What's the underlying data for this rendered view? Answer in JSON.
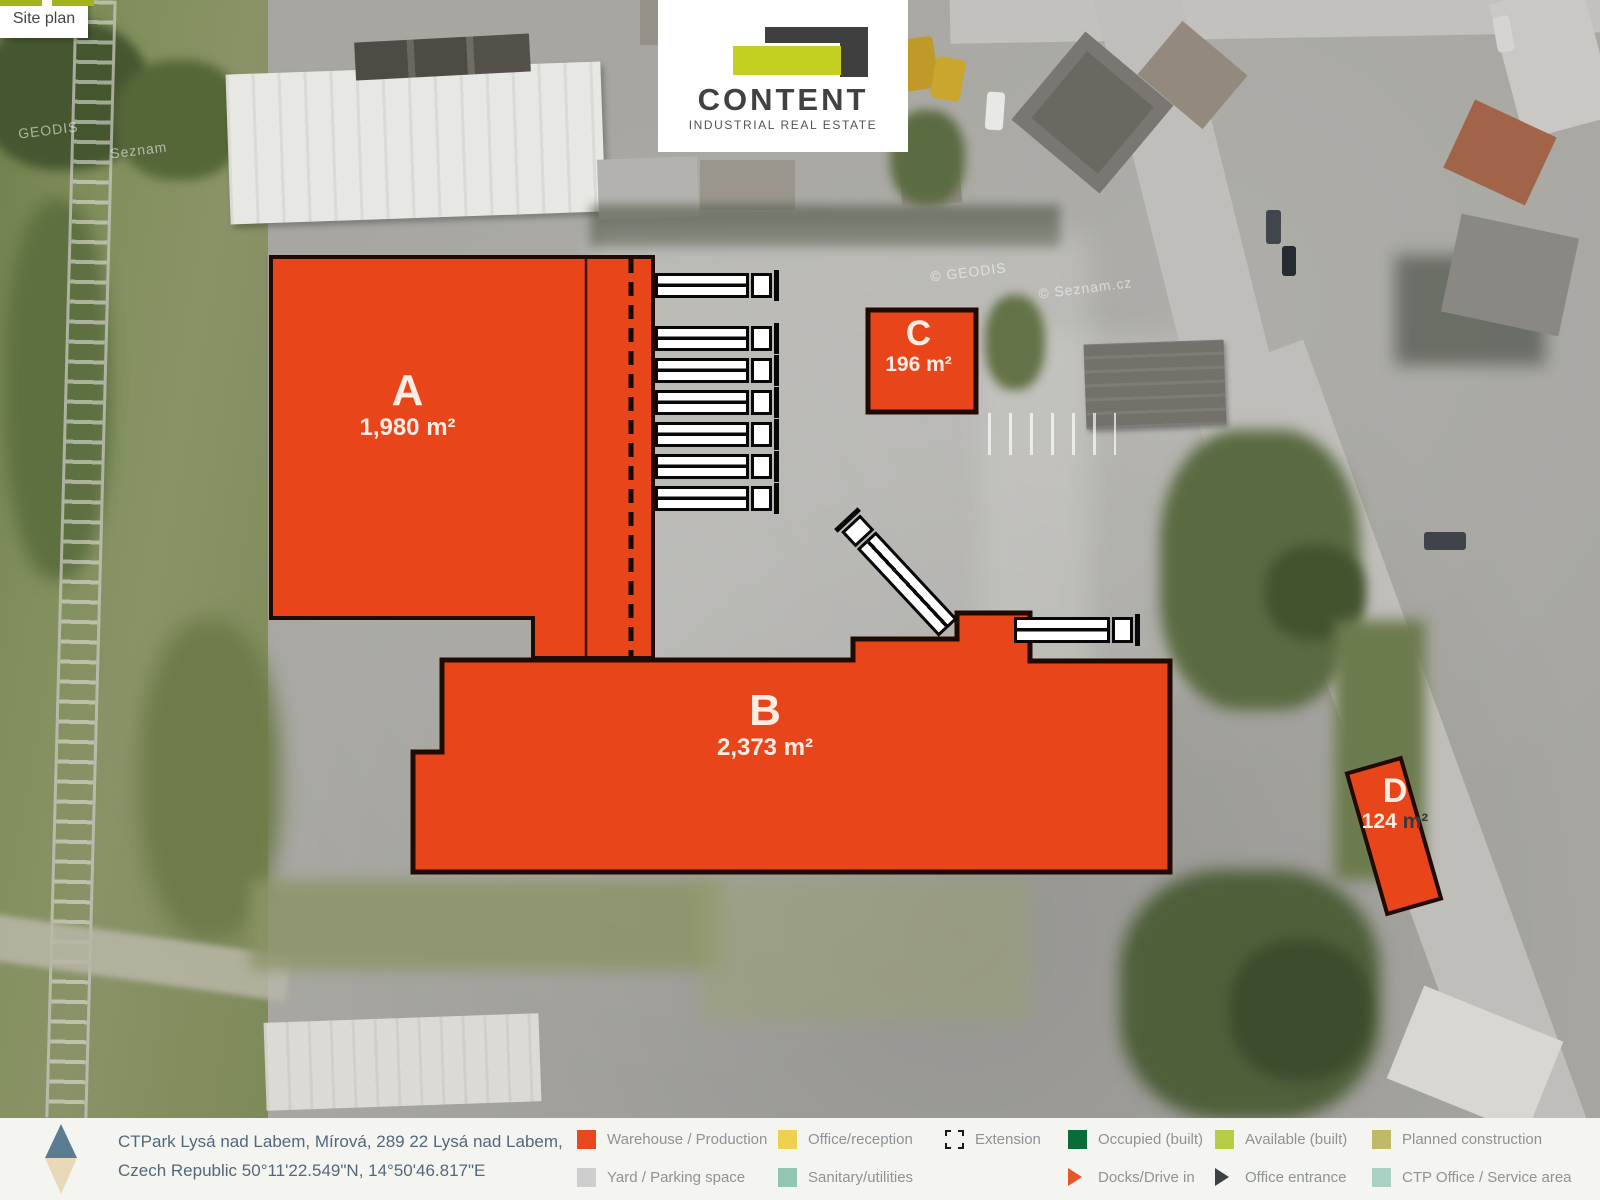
{
  "tab": {
    "label": "Site plan"
  },
  "logo": {
    "name": "CONTENT",
    "tagline": "INDUSTRIAL REAL ESTATE"
  },
  "buildings": [
    {
      "id": "A",
      "area": "1,980 m²"
    },
    {
      "id": "B",
      "area": "2,373 m²"
    },
    {
      "id": "C",
      "area": "196 m²"
    },
    {
      "id": "D",
      "area": "124 m²",
      "area_value": "124",
      "area_unit": "m²"
    }
  ],
  "footer": {
    "address_line1": "CTPark Lysá nad Labem, Mírová, 289 22 Lysá nad Labem,",
    "address_line2": "Czech Republic 50°11'22.549\"N, 14°50'46.817\"E"
  },
  "legend": {
    "items": [
      {
        "label": "Warehouse / Production",
        "type": "square",
        "color": "#e8481d"
      },
      {
        "label": "Yard / Parking space",
        "type": "square",
        "color": "#cecece"
      },
      {
        "label": "Office/reception",
        "type": "square",
        "color": "#eed14f"
      },
      {
        "label": "Sanitary/utilities",
        "type": "square",
        "color": "#93c6b1"
      },
      {
        "label": "Extension",
        "type": "dashed",
        "color": "#1a1a1a"
      },
      {
        "label": "Occupied (built)",
        "type": "square",
        "color": "#0a6c38"
      },
      {
        "label": "Docks/Drive in",
        "type": "triangle",
        "color": "#e8552b"
      },
      {
        "label": "Available (built)",
        "type": "square",
        "color": "#b7cd45"
      },
      {
        "label": "Office entrance",
        "type": "triangle",
        "color": "#3b4043"
      },
      {
        "label": "Planned construction",
        "type": "square",
        "color": "#bfb968"
      },
      {
        "label": "CTP Office / Service area",
        "type": "square",
        "color": "#aacfc3"
      }
    ]
  },
  "photo": {
    "watermarks": [
      "GEODIS",
      "Seznam",
      "© GEODIS",
      "© Seznam.cz"
    ]
  },
  "colors": {
    "building_fill": "#e8451b",
    "building_stroke": "#200b03",
    "accent_green": "#a3b31c",
    "logo_yellow": "#c3d021",
    "logo_gray": "#3f3f3f"
  }
}
